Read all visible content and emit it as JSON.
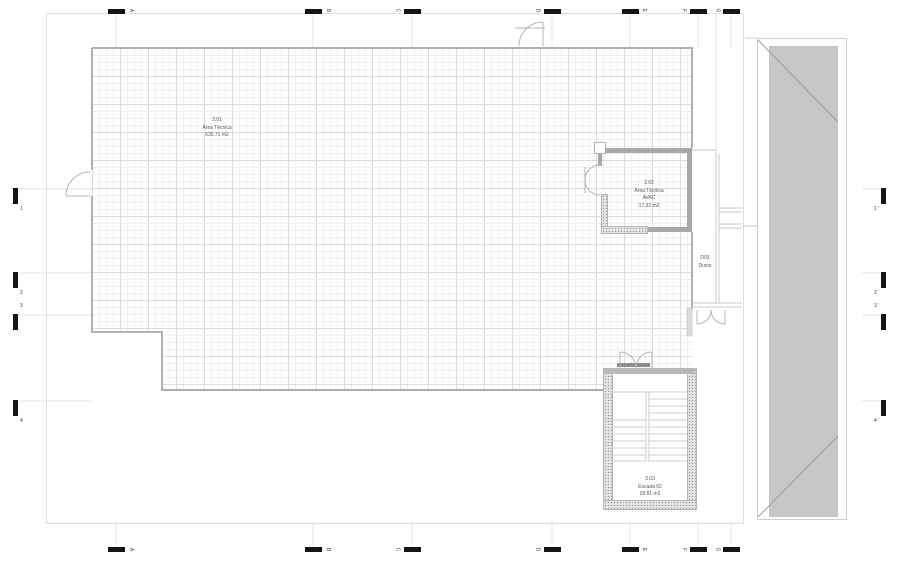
{
  "drawing": {
    "rooms": [
      {
        "id": "room-3-01",
        "number": "3.01",
        "name": "Área Técnica",
        "area": "535.71 m2"
      },
      {
        "id": "room-3-02",
        "number": "3.02",
        "name": "Área Técnica",
        "subname": "AVAC",
        "area": "17.32 m2"
      },
      {
        "id": "duct-d03",
        "number": "D03",
        "name": "Ducto"
      },
      {
        "id": "stair-02",
        "number": "3.03",
        "name": "Escada 02",
        "area": "28.81 m2"
      }
    ],
    "grid": {
      "columns": [
        "A",
        "B",
        "C",
        "D",
        "E",
        "F",
        "G"
      ],
      "rows_left": [
        "1",
        "2",
        "3",
        "4"
      ],
      "rows_right": [
        "1 '",
        "2 '",
        "3 '",
        "4 '"
      ]
    },
    "colors": {
      "wall_grey": "#a8a8a8",
      "marker_black": "#151515",
      "roof_fill": "#c6c6c6",
      "grid_minor": "#efefef",
      "grid_major": "#dcdcdc",
      "line_grey": "#b0b0b0",
      "label_text": "#555555"
    }
  }
}
